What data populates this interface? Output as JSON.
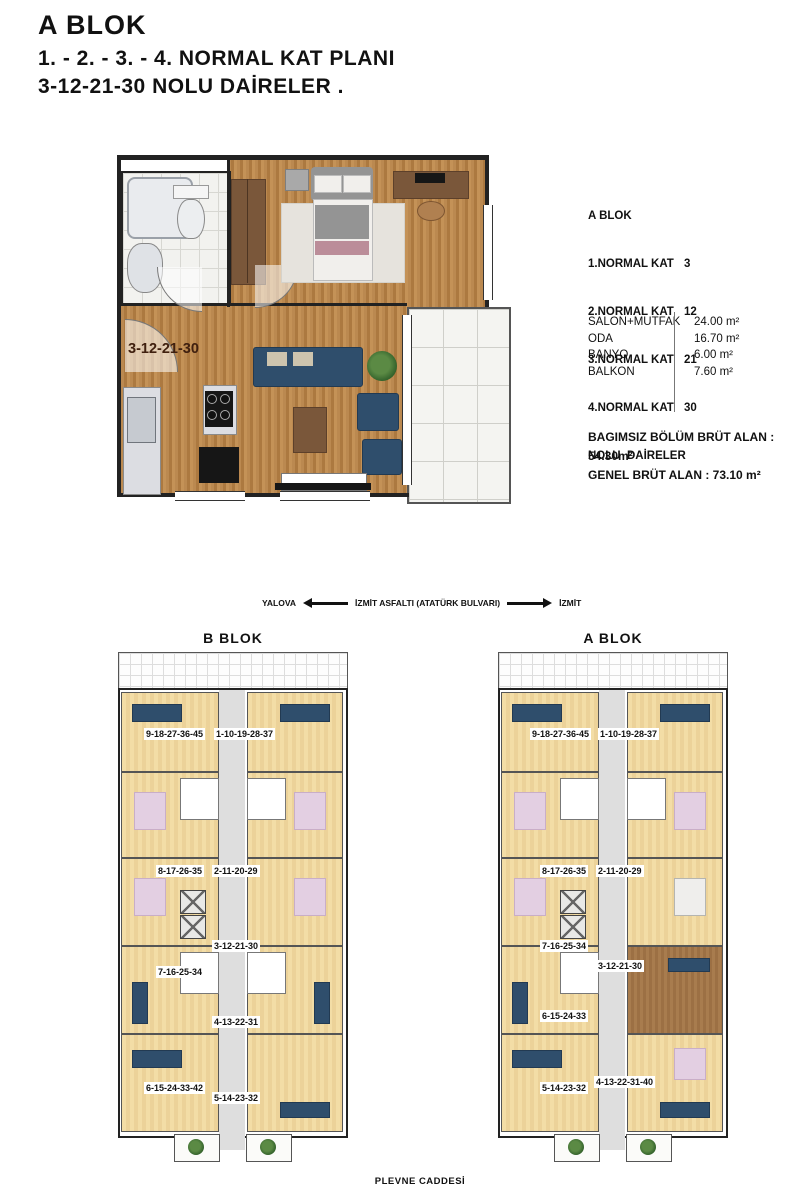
{
  "header": {
    "line1": "A BLOK",
    "line2": "1. - 2. - 3. - 4. NORMAL   KAT  PLANI",
    "line3": "3-12-21-30 NOLU DAİRELER ."
  },
  "unit_info": {
    "block": "A BLOK",
    "floors": [
      {
        "label": "1.NORMAL KAT",
        "value": "3"
      },
      {
        "label": "2.NORMAL KAT",
        "value": "12"
      },
      {
        "label": "3.NORMAL KAT",
        "value": "21"
      },
      {
        "label": "4.NORMAL KAT",
        "value": "30"
      }
    ],
    "suffix": "NOLU  DAİRELER"
  },
  "areas": {
    "rows": [
      {
        "name": "SALON+MUTFAK",
        "value": "24.00 m²"
      },
      {
        "name": "ODA",
        "value": "16.70 m²"
      },
      {
        "name": "BANYO",
        "value": "6.00 m²"
      },
      {
        "name": "BALKON",
        "value": "7.60 m²"
      }
    ],
    "gross1": "BAGIMSIZ  BÖLÜM BRÜT ALAN : 54.30m²",
    "gross2": "GENEL BRÜT ALAN : 73.10 m²"
  },
  "detail_plan": {
    "unit_label": "3-12-21-30"
  },
  "direction": {
    "left_city": "YALOVA",
    "road": "İZMİT ASFALTI  (ATATÜRK  BULVARI)",
    "right_city": "İZMİT"
  },
  "buildings": {
    "b": {
      "title": "B BLOK",
      "units": [
        "9-18-27-36-45",
        "1-10-19-28-37",
        "8-17-26-35",
        "2-11-20-29",
        "3-12-21-30",
        "7-16-25-34",
        "4-13-22-31",
        "6-15-24-33-42",
        "5-14-23-32"
      ]
    },
    "a": {
      "title": "A BLOK",
      "units": [
        "9-18-27-36-45",
        "1-10-19-28-37",
        "8-17-26-35",
        "2-11-20-29",
        "7-16-25-34",
        "3-12-21-30",
        "6-15-24-33",
        "4-13-22-31-40",
        "5-14-23-32"
      ]
    }
  },
  "street": "PLEVNE CADDESİ",
  "colors": {
    "sofa_navy": "#2f4e6c",
    "wood_floor": "#b5803f",
    "pale_unit_floor": "#f3dda6",
    "highlight_unit_floor": "#a87c4e",
    "label_brown": "#40200f"
  }
}
